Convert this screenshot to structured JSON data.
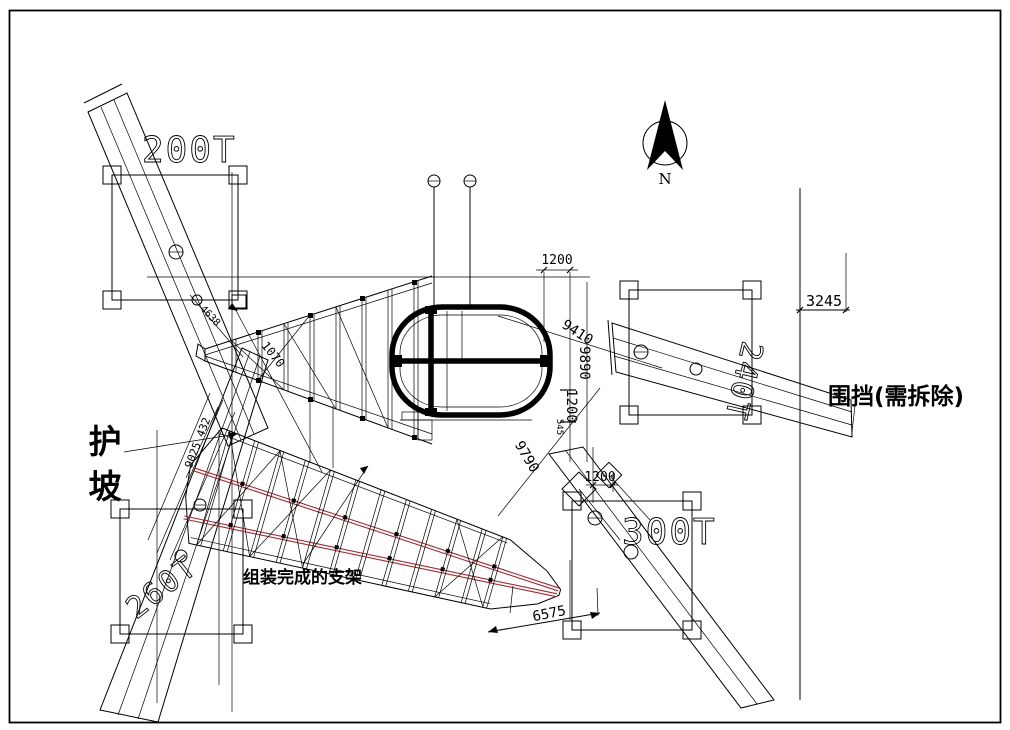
{
  "labels": {
    "north": "N",
    "crane_200t": "200T",
    "crane_240t": "240T",
    "crane_260t": "260T",
    "crane_300t": "300T",
    "slope_protection": "护坡",
    "fence_note": "围挡(需拆除)",
    "assembled_support_frame": "组装完成的支架"
  },
  "dimensions": {
    "fence_offset": "3245",
    "hanger_spacing": "1200",
    "ring_diag": "9410",
    "ring_vertical": "9890",
    "ring_offset": "1200",
    "ring_small": "545",
    "crane300_offset": "1200",
    "frame_diag": "9790",
    "frame_tip": "6575",
    "truss_diag": "1070",
    "truss_small": "4638",
    "slope_diag": "9025 432"
  },
  "colors": {
    "line": "#000000",
    "red_chord": "#9e2b35",
    "background": "#ffffff"
  }
}
